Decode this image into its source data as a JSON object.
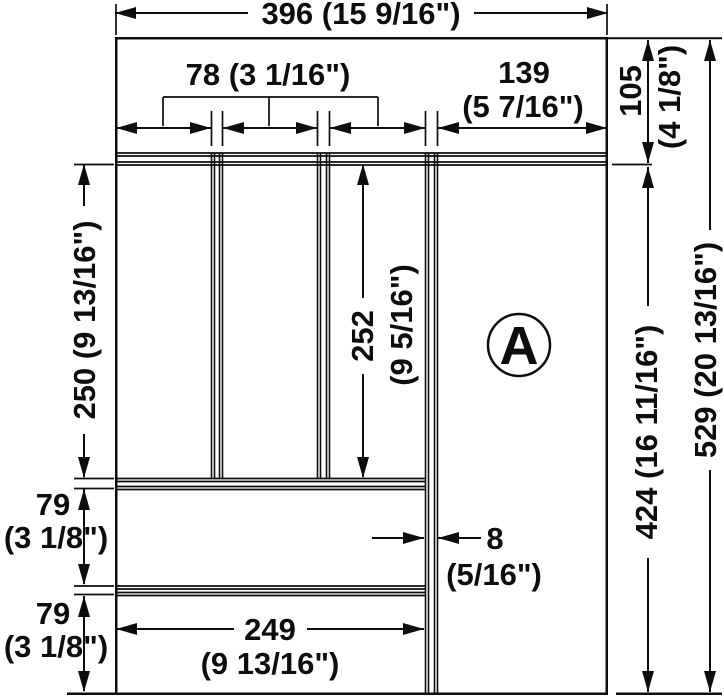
{
  "diagram": {
    "type": "technical-drawing",
    "part_label": "A",
    "line_color": "#0d0d0d",
    "background_color": "#ffffff",
    "dimensions": {
      "total_width": "396 (15 9/16\")",
      "compartment_width": "78 (3 1/16\")",
      "right_compartment_width_mm": "139",
      "right_compartment_width_in": "(5 7/16\")",
      "top_section_height_mm": "105",
      "top_section_height_in": "(4 1/8\")",
      "upper_left_height": "250 (9 13/16\")",
      "center_height_mm": "252",
      "center_height_in": "(9 5/16\")",
      "right_inner_height": "424 (16 11/16\")",
      "total_height": "529 (20 13/16\")",
      "row1_height_mm": "79",
      "row1_height_in": "(3 1/8\")",
      "row2_height_mm": "79",
      "row2_height_in": "(3 1/8\")",
      "divider_thickness_mm": "8",
      "divider_thickness_in": "(5/16\")",
      "bottom_compartment_width_mm": "249",
      "bottom_compartment_width_in": "(9 13/16\")"
    }
  }
}
